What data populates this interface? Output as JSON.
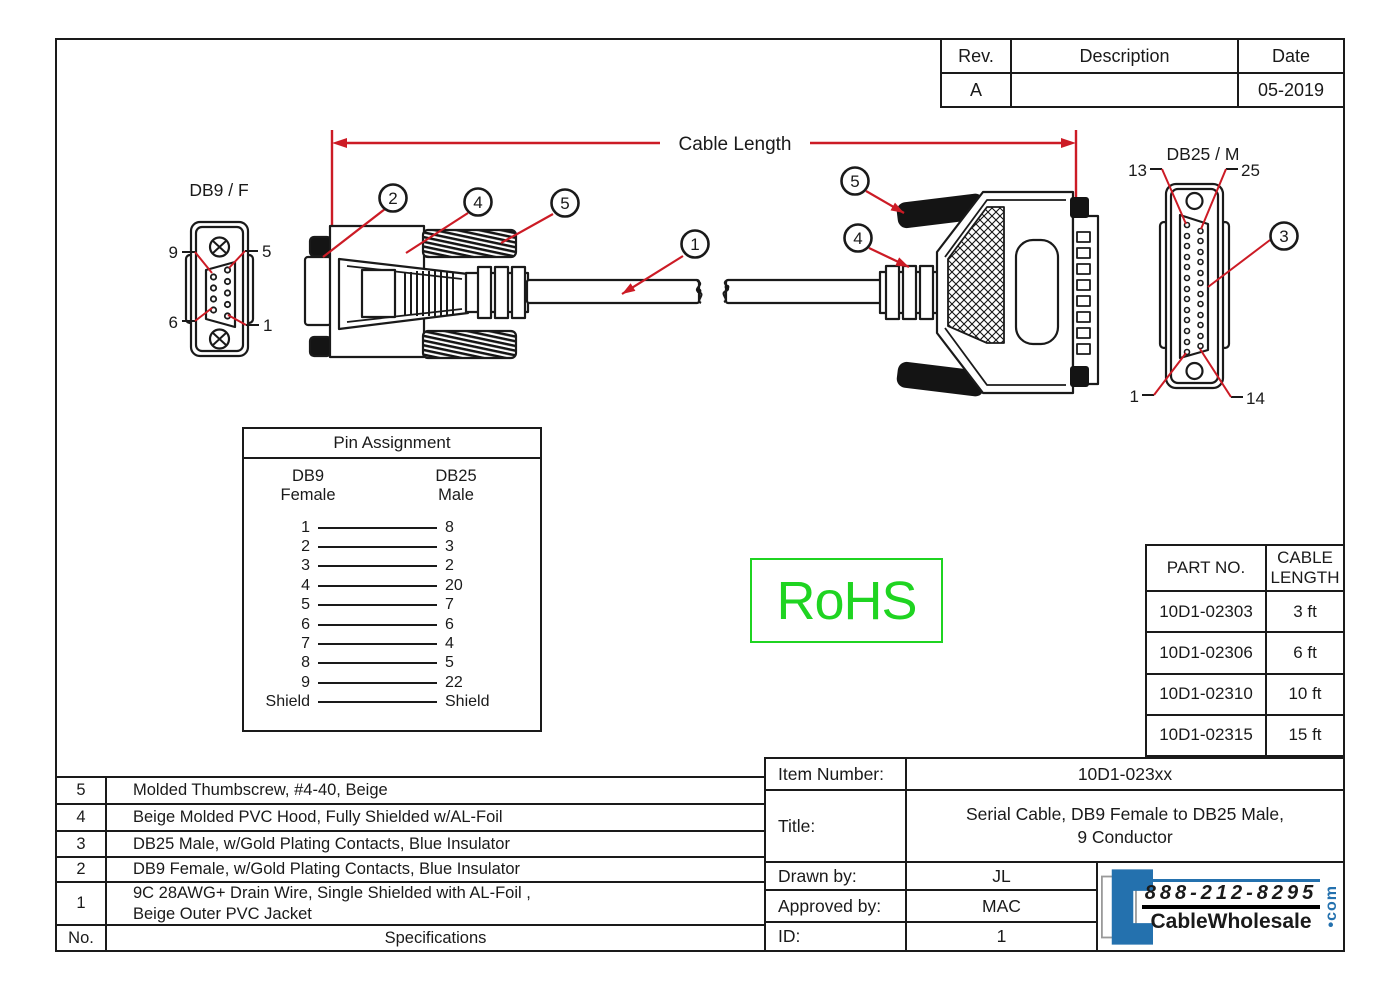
{
  "rev_table": {
    "col_rev": "Rev.",
    "col_desc": "Description",
    "col_date": "Date",
    "row": {
      "rev": "A",
      "desc": "",
      "date": "05-2019"
    }
  },
  "dimension": {
    "label": "Cable Length"
  },
  "connectors": {
    "db9_front": {
      "label": "DB9 / F",
      "pin_top_left": "9",
      "pin_top_right": "5",
      "pin_bottom_left": "6",
      "pin_bottom_right": "1"
    },
    "db25_front": {
      "label": "DB25 / M",
      "pin_top_left": "13",
      "pin_top_right": "25",
      "pin_bottom_left": "1",
      "pin_bottom_right": "14",
      "callout": "3"
    },
    "callouts": {
      "c1": "1",
      "c2": "2",
      "c4_left": "4",
      "c5_left": "5",
      "c5_right": "5",
      "c4_right": "4"
    }
  },
  "pin_assignment": {
    "title": "Pin Assignment",
    "left_header_line1": "DB9",
    "left_header_line2": "Female",
    "right_header_line1": "DB25",
    "right_header_line2": "Male",
    "rows": [
      [
        "1",
        "8"
      ],
      [
        "2",
        "3"
      ],
      [
        "3",
        "2"
      ],
      [
        "4",
        "20"
      ],
      [
        "5",
        "7"
      ],
      [
        "6",
        "6"
      ],
      [
        "7",
        "4"
      ],
      [
        "8",
        "5"
      ],
      [
        "9",
        "22"
      ],
      [
        "Shield",
        "Shield"
      ]
    ]
  },
  "rohs_label": "RoHS",
  "part_table": {
    "col_part": "PART NO.",
    "col_length": "CABLE LENGTH",
    "rows": [
      {
        "part": "10D1-02303",
        "length": "3 ft"
      },
      {
        "part": "10D1-02306",
        "length": "6 ft"
      },
      {
        "part": "10D1-02310",
        "length": "10 ft"
      },
      {
        "part": "10D1-02315",
        "length": "15 ft"
      }
    ]
  },
  "spec_table": {
    "rows": [
      {
        "no": "5",
        "text": "Molded Thumbscrew, #4-40,  Beige"
      },
      {
        "no": "4",
        "text": "Beige Molded PVC Hood, Fully Shielded w/AL-Foil"
      },
      {
        "no": "3",
        "text": "DB25 Male, w/Gold Plating Contacts, Blue Insulator"
      },
      {
        "no": "2",
        "text": "DB9 Female, w/Gold Plating Contacts, Blue Insulator"
      },
      {
        "no": "1",
        "text": "9C 28AWG+ Drain Wire, Single Shielded with AL-Foil ,\nBeige Outer PVC Jacket"
      }
    ],
    "footer_no": "No.",
    "footer_text": "Specifications"
  },
  "title_block": {
    "item_label": "Item Number:",
    "item_value": "10D1-023xx",
    "title_label": "Title:",
    "title_value": "Serial Cable, DB9 Female to DB25 Male,\n9 Conductor",
    "drawn_label": "Drawn by:",
    "drawn_value": "JL",
    "approved_label": "Approved by:",
    "approved_value": "MAC",
    "id_label": "ID:",
    "id_value": "1"
  },
  "logo": {
    "phone": "888-212-8295",
    "name": "CableWholesale",
    "tld": "com"
  },
  "colors": {
    "line": "#1a1a1a",
    "leader_red": "#cc1b25",
    "rohs_green": "#1fd421",
    "logo_blue": "#2471ae"
  }
}
